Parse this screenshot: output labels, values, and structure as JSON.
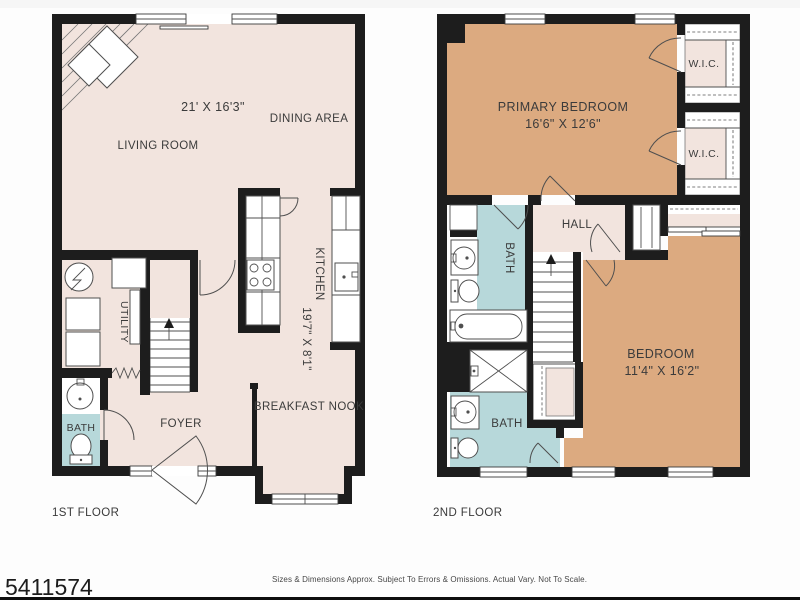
{
  "document": {
    "listing_id": "5411574",
    "disclaimer": "Sizes & Dimensions Approx. Subject To Errors & Omissions. Actual Vary. Not To Scale."
  },
  "colors": {
    "wall": "#1d1d1d",
    "floor": "#f2e4de",
    "bedroom_floor": "#dcaa80",
    "bath_floor": "#b7d8da",
    "background": "#ffffff"
  },
  "floor1": {
    "label": "1ST FLOOR",
    "rooms": {
      "living_room": {
        "name": "LIVING ROOM",
        "dims": "21' X 16'3\""
      },
      "dining_area": {
        "name": "DINING AREA"
      },
      "kitchen": {
        "name": "KITCHEN",
        "dims": "19'7\" X 8'1\""
      },
      "utility": {
        "name": "UTILITY"
      },
      "bath": {
        "name": "BATH"
      },
      "foyer": {
        "name": "FOYER"
      },
      "breakfast_nook": {
        "name": "BREAKFAST NOOK"
      }
    }
  },
  "floor2": {
    "label": "2ND FLOOR",
    "rooms": {
      "primary_bedroom": {
        "name": "PRIMARY BEDROOM",
        "dims": "16'6\" X 12'6\""
      },
      "wic_upper": {
        "name": "W.I.C."
      },
      "wic_lower": {
        "name": "W.I.C."
      },
      "hall": {
        "name": "HALL"
      },
      "bath_upper": {
        "name": "BATH"
      },
      "bath_lower": {
        "name": "BATH"
      },
      "bedroom": {
        "name": "BEDROOM",
        "dims": "11'4\" X 16'2\""
      }
    }
  }
}
